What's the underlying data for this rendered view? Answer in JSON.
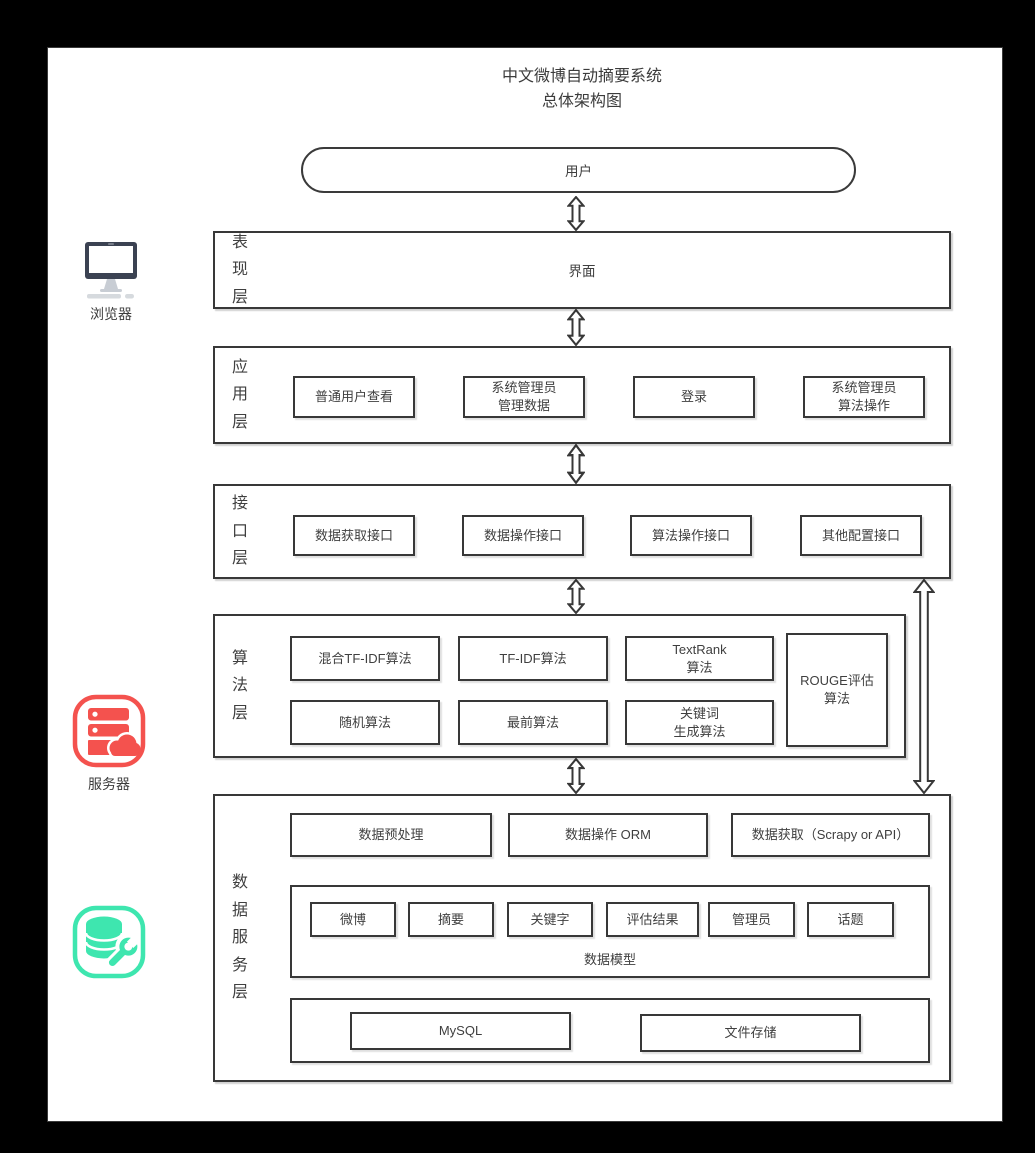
{
  "colors": {
    "line": "#3A3A3A",
    "text": "#3F3F3F",
    "server_red": "#F4524E",
    "database_green": "#3EE6AF",
    "monitor_dark": "#3B4252"
  },
  "title": {
    "line1": "中文微博自动摘要系统",
    "line2": "总体架构图"
  },
  "user_node": {
    "label": "用户"
  },
  "left_panel": {
    "browser": {
      "icon": "monitor-icon",
      "label": "浏览器"
    },
    "server": {
      "icon": "server-cloud-icon",
      "label": "服务器"
    },
    "database": {
      "icon": "database-wrench-icon"
    }
  },
  "layers": {
    "presentation": {
      "label": "表现层",
      "content": "界面"
    },
    "application": {
      "label": "应用层",
      "items": [
        "普通用户查看",
        "系统管理员\n管理数据",
        "登录",
        "系统管理员\n算法操作"
      ]
    },
    "interface": {
      "label": "接口层",
      "items": [
        "数据获取接口",
        "数据操作接口",
        "算法操作接口",
        "其他配置接口"
      ]
    },
    "algorithm": {
      "label": "算法层",
      "row1": [
        "混合TF-IDF算法",
        "TF-IDF算法",
        "TextRank\n算法"
      ],
      "row2": [
        "随机算法",
        "最前算法",
        "关键词\n生成算法"
      ],
      "side_box": "ROUGE评估\n算法"
    },
    "data_service": {
      "label": "数据服务层",
      "top_items": [
        "数据预处理",
        "数据操作 ORM",
        "数据获取（Scrapy or API）"
      ],
      "data_model": {
        "label": "数据模型",
        "entities": [
          "微博",
          "摘要",
          "关键字",
          "评估结果",
          "管理员",
          "话题"
        ]
      },
      "storage_items": [
        "MySQL",
        "文件存储"
      ]
    }
  }
}
